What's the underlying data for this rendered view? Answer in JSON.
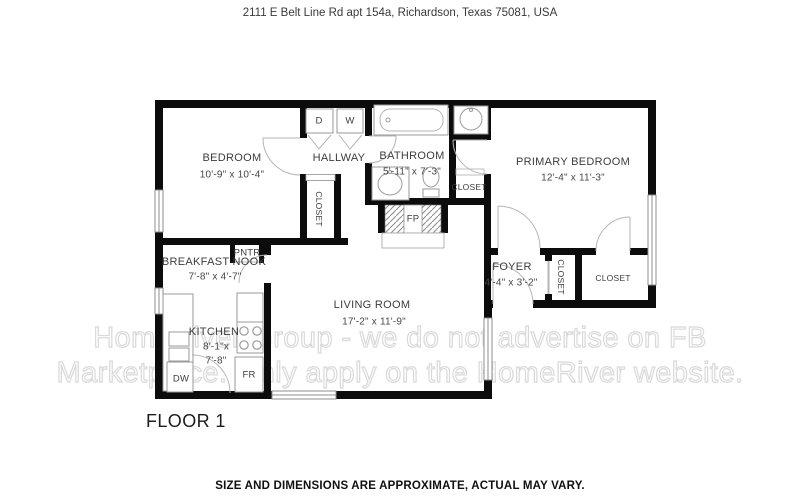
{
  "header": {
    "address": "2111 E Belt Line Rd apt 154a, Richardson, Texas 75081, USA"
  },
  "rooms": {
    "bedroom": {
      "name": "BEDROOM",
      "dims": "10'-9\" x  10'-4\""
    },
    "hallway": {
      "name": "HALLWAY"
    },
    "bathroom": {
      "name": "BATHROOM",
      "dims": "5'-11\" x  7'-3\""
    },
    "primary_bedroom": {
      "name": "PRIMARY BEDROOM",
      "dims": "12'-4\" x  11'-3\""
    },
    "breakfast_nook": {
      "name": "BREAKFAST NOOK",
      "dims": "7'-8\" x  4'-7\""
    },
    "kitchen": {
      "name": "KITCHEN",
      "dims_line1": "8'-1\"x",
      "dims_line2": "7'-8\""
    },
    "living_room": {
      "name": "LIVING ROOM",
      "dims": "17'-2\" x  11'-9\""
    },
    "foyer": {
      "name": "FOYER",
      "dims": "4'-4\" x  3'-2\""
    }
  },
  "fixtures": {
    "dryer": "D",
    "washer": "W",
    "dishwasher": "DW",
    "fridge": "FR",
    "fireplace": "FP",
    "pantry": "PNTR",
    "closet": "CLOSET"
  },
  "watermark": {
    "line1": "HomeRiver Group - we do not advertise on FB",
    "line2": "Marketplace. Only apply on the HomeRiver website."
  },
  "floor": {
    "label": "FLOOR 1"
  },
  "footer": {
    "disclaimer": "SIZE AND DIMENSIONS ARE APPROXIMATE, ACTUAL MAY VARY."
  },
  "colors": {
    "wall": "#0c0c0c",
    "fixture_stroke": "#9a9a9a",
    "door_stroke": "#b5b5b5",
    "text": "#3d3d3d",
    "watermark_stroke": "#d9d9d9"
  }
}
